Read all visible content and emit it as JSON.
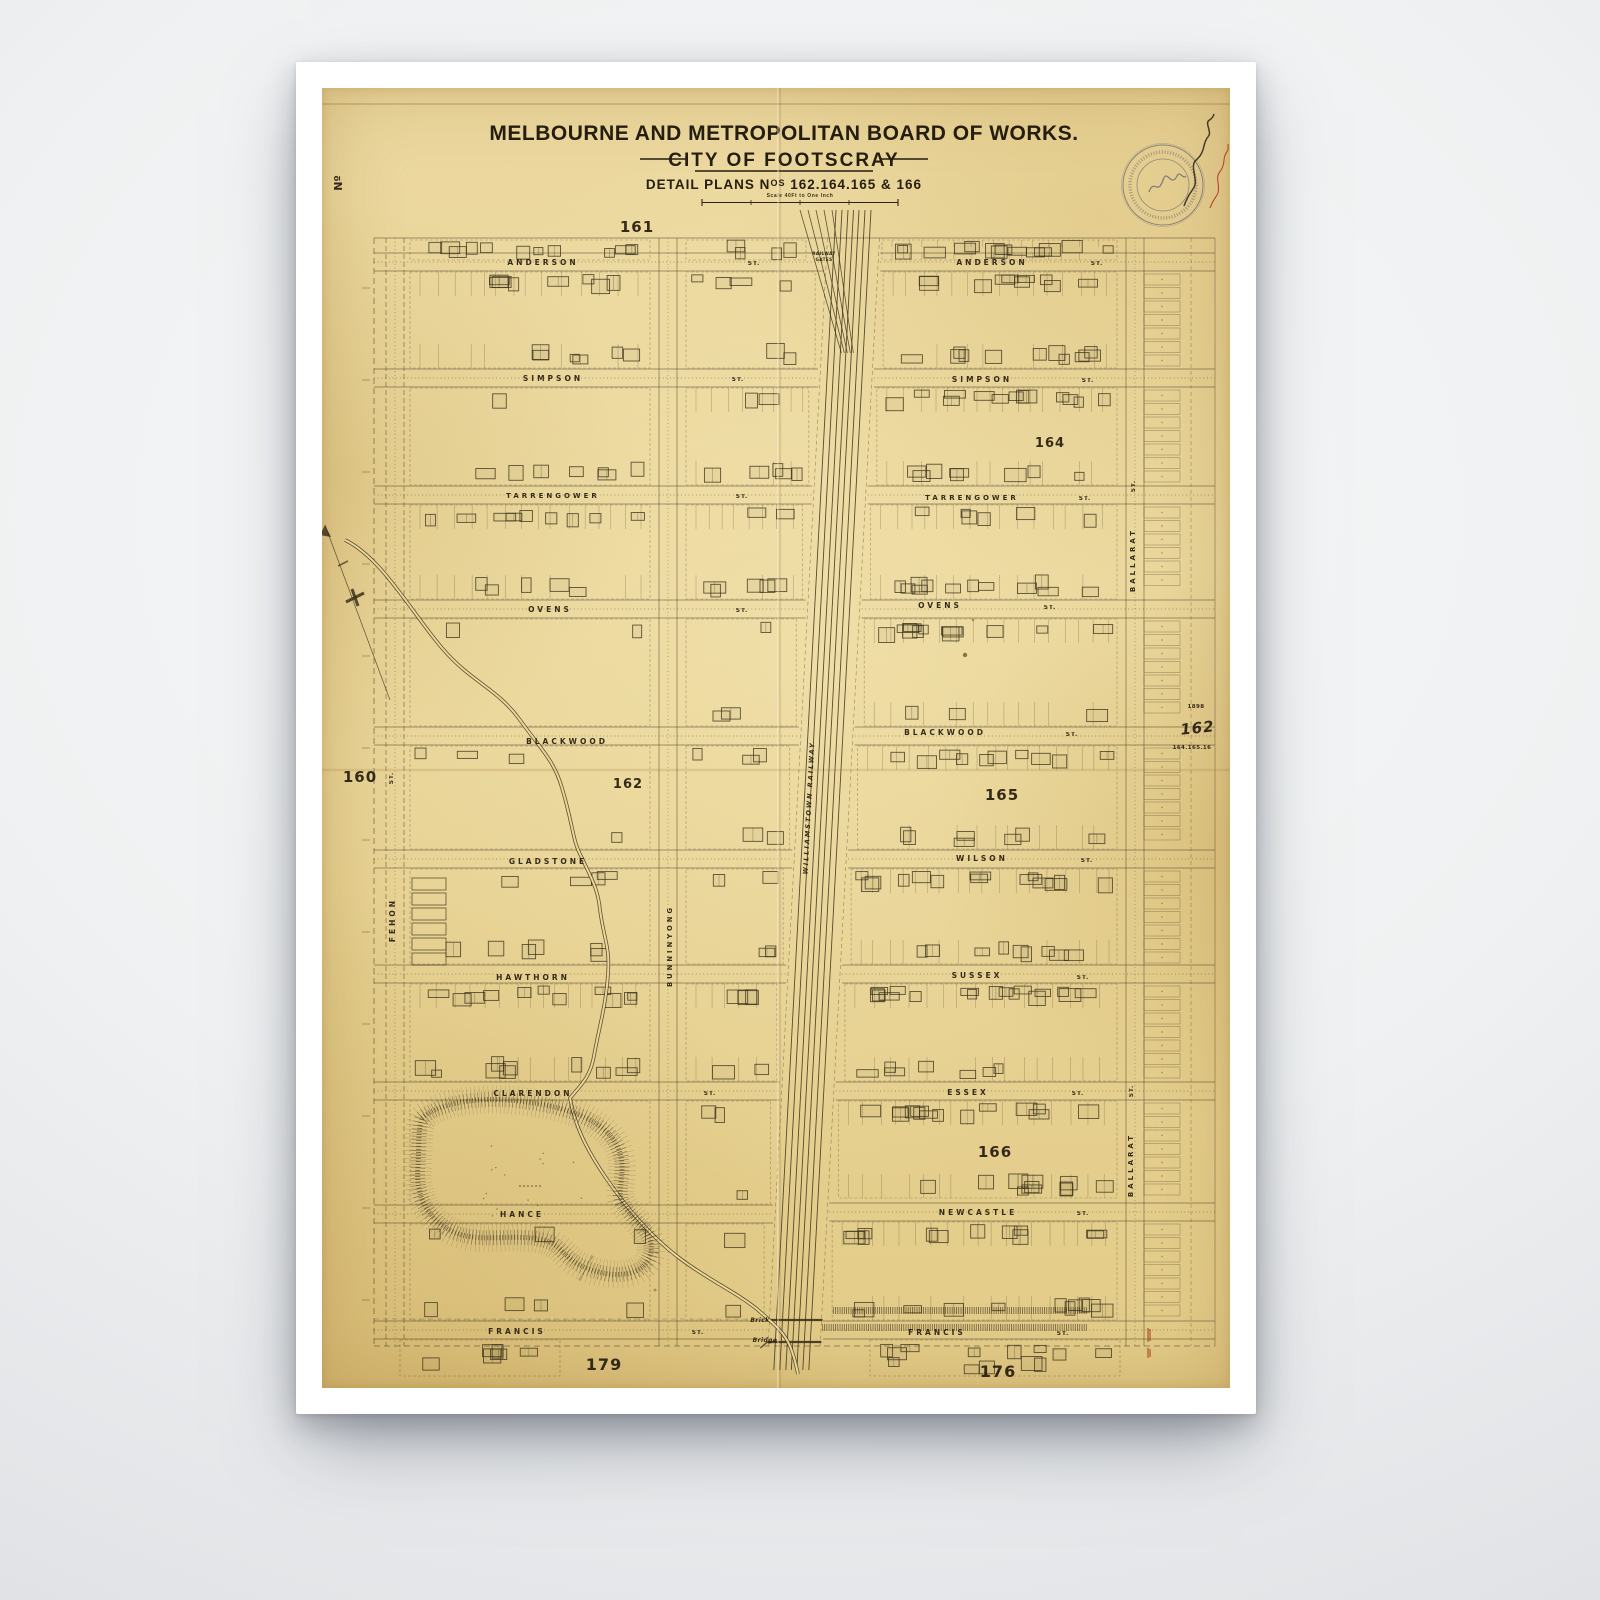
{
  "colors": {
    "paper": "#e9d79c",
    "ink": "#3d321c",
    "stamp_ring": "#6a6a78",
    "stamp_red": "#b5371f",
    "plan164": "#76341b",
    "pencil": "#a08a58"
  },
  "title": {
    "board": "MELBOURNE AND METROPOLITAN BOARD OF WORKS.",
    "city": "CITY OF FOOTSCRAY",
    "plans_prefix": "DETAIL PLANS N",
    "plans_sup": "OS",
    "plans_numbers": " 162.164.165 & 166",
    "scale_note": "Scale 40Ft to One Inch"
  },
  "map": {
    "labels": [
      {
        "t": "Nº",
        "x": 20,
        "y": 95,
        "r": -90,
        "s": 11,
        "ls": 0
      },
      {
        "t": "161",
        "x": 315,
        "y": 144,
        "s": 15,
        "ls": 1
      },
      {
        "t": "160",
        "x": 38,
        "y": 694,
        "s": 15,
        "ls": 1
      },
      {
        "t": "162",
        "x": 306,
        "y": 700,
        "s": 13,
        "ls": 1
      },
      {
        "t": "164",
        "x": 728,
        "y": 359,
        "s": 13,
        "ls": 1,
        "c": "#76341b"
      },
      {
        "t": "165",
        "x": 680,
        "y": 712,
        "s": 15,
        "ls": 1
      },
      {
        "t": "166",
        "x": 673,
        "y": 1069,
        "s": 15,
        "ls": 1
      },
      {
        "t": "179",
        "x": 282,
        "y": 1282,
        "s": 16,
        "ls": 1
      },
      {
        "t": "176",
        "x": 676,
        "y": 1289,
        "s": 16,
        "ls": 1
      },
      {
        "t": "ANDERSON",
        "x": 221,
        "y": 177
      },
      {
        "t": "ST.",
        "x": 432,
        "y": 177,
        "s": 5.8,
        "ls": 1
      },
      {
        "t": "ANDERSON",
        "x": 670,
        "y": 177
      },
      {
        "t": "ST.",
        "x": 775,
        "y": 177,
        "s": 5.8,
        "ls": 1
      },
      {
        "t": "SIMPSON",
        "x": 231,
        "y": 293
      },
      {
        "t": "ST.",
        "x": 416,
        "y": 293,
        "s": 5.8,
        "ls": 1
      },
      {
        "t": "SIMPSON",
        "x": 660,
        "y": 294
      },
      {
        "t": "ST.",
        "x": 766,
        "y": 294,
        "s": 5.8,
        "ls": 1
      },
      {
        "t": "TARRENGOWER",
        "x": 231,
        "y": 410,
        "s": 7
      },
      {
        "t": "ST.",
        "x": 420,
        "y": 410,
        "s": 5.8,
        "ls": 1
      },
      {
        "t": "TARRENGOWER",
        "x": 650,
        "y": 412,
        "s": 7
      },
      {
        "t": "ST.",
        "x": 763,
        "y": 412,
        "s": 5.8,
        "ls": 1
      },
      {
        "t": "OVENS",
        "x": 228,
        "y": 524
      },
      {
        "t": "ST.",
        "x": 420,
        "y": 524,
        "s": 5.8,
        "ls": 1
      },
      {
        "t": "OVENS",
        "x": 618,
        "y": 520
      },
      {
        "t": "ST.",
        "x": 728,
        "y": 521,
        "s": 5.8,
        "ls": 1
      },
      {
        "t": "BLACKWOOD",
        "x": 245,
        "y": 656
      },
      {
        "t": "BLACKWOOD",
        "x": 623,
        "y": 647
      },
      {
        "t": "ST.",
        "x": 750,
        "y": 648,
        "s": 5.8,
        "ls": 1
      },
      {
        "t": "GLADSTONE",
        "x": 226,
        "y": 776
      },
      {
        "t": "WILSON",
        "x": 660,
        "y": 773
      },
      {
        "t": "ST.",
        "x": 765,
        "y": 774,
        "s": 5.8,
        "ls": 1
      },
      {
        "t": "HAWTHORN",
        "x": 211,
        "y": 892
      },
      {
        "t": "SUSSEX",
        "x": 655,
        "y": 890
      },
      {
        "t": "ST.",
        "x": 761,
        "y": 891,
        "s": 5.8,
        "ls": 1
      },
      {
        "t": "CLARENDON",
        "x": 211,
        "y": 1008
      },
      {
        "t": "ST.",
        "x": 388,
        "y": 1007,
        "s": 5.8,
        "ls": 1
      },
      {
        "t": "ESSEX",
        "x": 646,
        "y": 1007
      },
      {
        "t": "ST.",
        "x": 756,
        "y": 1007,
        "s": 5.8,
        "ls": 1
      },
      {
        "t": "HANCE",
        "x": 200,
        "y": 1129
      },
      {
        "t": "NEWCASTLE",
        "x": 656,
        "y": 1127
      },
      {
        "t": "ST.",
        "x": 761,
        "y": 1127,
        "s": 5.8,
        "ls": 1
      },
      {
        "t": "FRANCIS",
        "x": 195,
        "y": 1246
      },
      {
        "t": "ST.",
        "x": 376,
        "y": 1246,
        "s": 5.8,
        "ls": 1
      },
      {
        "t": "FRANCIS",
        "x": 615,
        "y": 1247
      },
      {
        "t": "ST.",
        "x": 741,
        "y": 1247,
        "s": 5.8,
        "ls": 1
      },
      {
        "t": "FEHON",
        "x": 73,
        "y": 832,
        "r": -90
      },
      {
        "t": "ST.",
        "x": 71,
        "y": 690,
        "r": -90,
        "s": 5.8,
        "ls": 1
      },
      {
        "t": "BUNNINYONG",
        "x": 350,
        "y": 858,
        "r": -90,
        "s": 6.8
      },
      {
        "t": "BALLARAT",
        "x": 813,
        "y": 472,
        "r": -90,
        "s": 7
      },
      {
        "t": "ST.",
        "x": 813,
        "y": 398,
        "r": -90,
        "s": 5.8,
        "ls": 1
      },
      {
        "t": "BALLARAT",
        "x": 811,
        "y": 1077,
        "r": -90,
        "s": 7
      },
      {
        "t": "ST.",
        "x": 811,
        "y": 1003,
        "r": -90,
        "s": 5.8,
        "ls": 1
      },
      {
        "t": "RAILWAY",
        "x": 502,
        "y": 167,
        "s": 4.2,
        "ls": 0.4
      },
      {
        "t": "GATES",
        "x": 502,
        "y": 173,
        "s": 4.2,
        "ls": 0.4
      },
      {
        "t": "WILLIAMSTOWN RAILWAY",
        "x": 489,
        "y": 720,
        "r": -87,
        "s": 6.5,
        "i": true,
        "c": "#4a3c20",
        "ls": 2
      },
      {
        "t": "Brick",
        "x": 438,
        "y": 1234,
        "s": 6,
        "i": true,
        "ls": 0.4
      },
      {
        "t": "Bridge",
        "x": 443,
        "y": 1254,
        "s": 6,
        "i": true,
        "ls": 0.4
      },
      {
        "t": "1898",
        "x": 874,
        "y": 620,
        "s": 5.5,
        "c": "#a08a58",
        "ls": 0.4
      },
      {
        "t": "162",
        "x": 876,
        "y": 645,
        "s": 15,
        "i": true,
        "r": -6,
        "c": "#a8905c",
        "ls": 1
      },
      {
        "t": "164.165.16",
        "x": 870,
        "y": 661,
        "s": 5.5,
        "c": "#a08a58",
        "ls": 0.4
      }
    ]
  }
}
